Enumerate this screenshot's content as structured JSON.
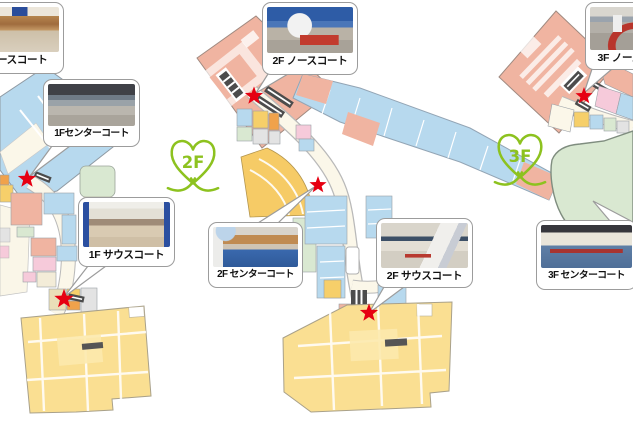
{
  "colors": {
    "star_red": "#e60012",
    "logo_green": "#8dc21f",
    "map_blue": "#b7d9ee",
    "map_salmon": "#f0b4a1",
    "map_pink": "#f6cada",
    "map_green": "#d9e8d1",
    "map_yellow_anchor": "#fadf92",
    "map_yellow_shop": "#f6cf6a",
    "map_orange": "#f0a24b",
    "map_gray": "#e3e3e3",
    "corridor_cream": "#fbf7e9",
    "escalator_dark": "#4c4c4c",
    "callout_border": "#9c9c9c"
  },
  "floors": [
    {
      "id": "1F",
      "callouts": {
        "north": "1F ノースコート",
        "center": "1Fセンターコート",
        "south": "1F サウスコート"
      }
    },
    {
      "id": "2F",
      "logo": "2F",
      "callouts": {
        "north": "2F ノースコート",
        "center": "2F センターコート",
        "south": "2F サウスコート"
      }
    },
    {
      "id": "3F",
      "logo": "3F",
      "callouts": {
        "north": "3F ノースコート",
        "center": "3F センターコート"
      }
    }
  ]
}
